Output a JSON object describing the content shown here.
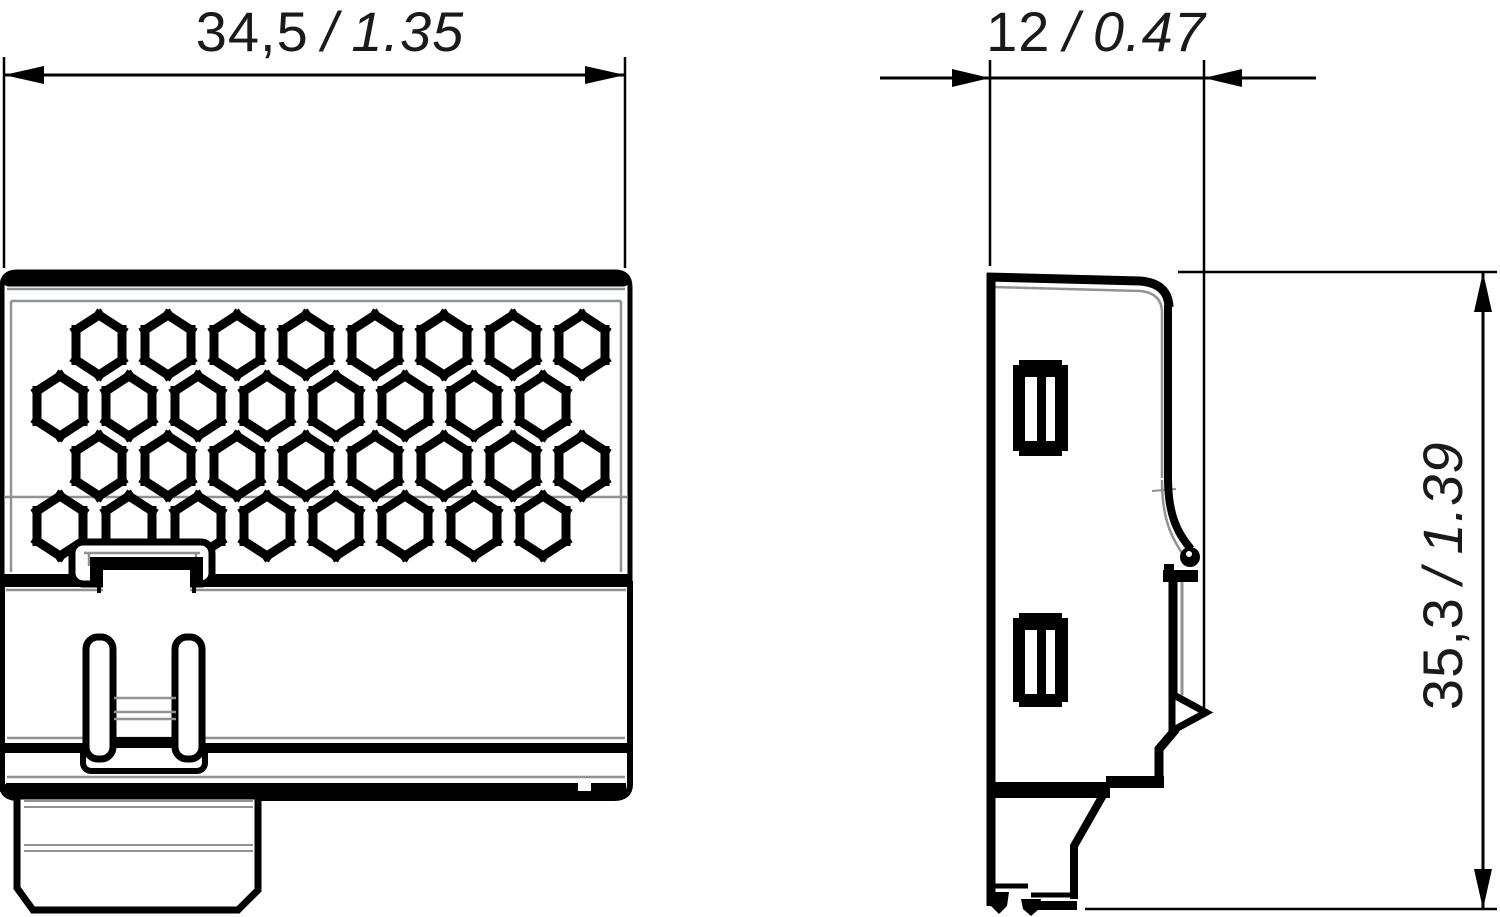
{
  "drawing": {
    "type": "technical-dimension-drawing",
    "views": [
      "front-view",
      "side-view"
    ]
  },
  "dimensions": {
    "width": {
      "metric": "34,5",
      "separator": "/",
      "inch": "1.35"
    },
    "depth": {
      "metric": "12",
      "separator": "/",
      "inch": "0.47"
    },
    "height": {
      "metric": "35,3",
      "separator": "/",
      "inch": "1.39"
    }
  },
  "colors": {
    "line": "#000000",
    "seam": "#8f9296",
    "background": "#ffffff",
    "text": "#1a1a1a"
  }
}
